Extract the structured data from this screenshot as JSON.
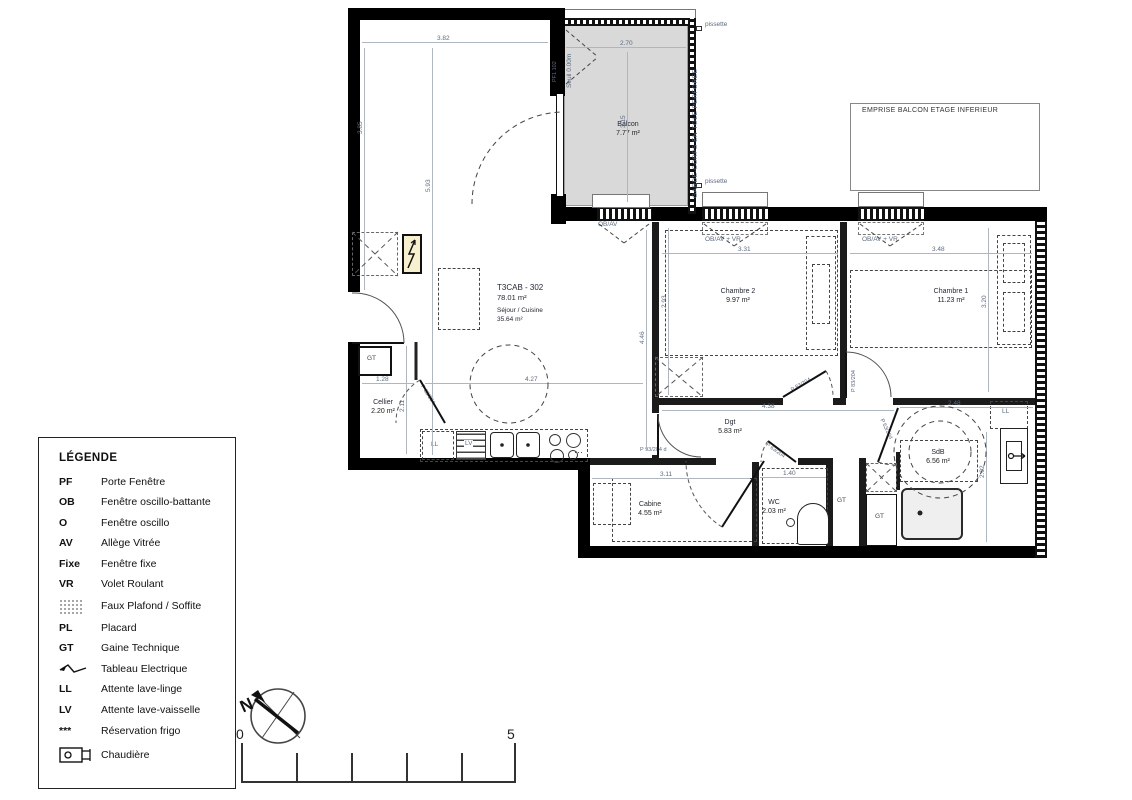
{
  "plan": {
    "unit_code": "T3CAB - 302",
    "unit_area": "78.01 m²",
    "rooms": {
      "sejour": {
        "name": "Séjour / Cuisine",
        "area": "35.64 m²"
      },
      "balcon": {
        "name": "Balcon",
        "area": "7.77 m²"
      },
      "chambre2": {
        "name": "Chambre 2",
        "area": "9.97 m²"
      },
      "chambre1": {
        "name": "Chambre 1",
        "area": "11.23 m²"
      },
      "cellier": {
        "name": "Cellier",
        "area": "2.20 m²"
      },
      "dgt": {
        "name": "Dgt",
        "area": "5.83 m²"
      },
      "cabine": {
        "name": "Cabine",
        "area": "4.55 m²"
      },
      "wc": {
        "name": "WC",
        "area": "2.03 m²"
      },
      "sdb": {
        "name": "SdB",
        "area": "6.56 m²"
      }
    },
    "annotations": {
      "emprise_balcon": "EMPRISE BALCON ETAGE INFERIEUR",
      "garde_corps": "GARDE-CORPS EN TOLE PERFOREE",
      "seuil": "Seuil 0.00m",
      "pissette": "pissette",
      "win_obav": "OB/AV",
      "win_obav_vr": "OB/AV + VR",
      "gt": "GT",
      "ll": "LL",
      "lv": "LV",
      "frigo_dots": "···"
    },
    "doors": {
      "pf": "PF1 102",
      "p83": "P 83/204",
      "p63": "P 63/204",
      "entry": "P 93/204 d"
    },
    "dims": {
      "sejour_w": "3.82",
      "sejour_wall": "3.85",
      "sejour_h": "5.93",
      "balcon_w": "2.70",
      "balcon_h": "3.15",
      "ch2_w": "3.31",
      "ch2_h": "2.93",
      "ch1_w": "3.48",
      "ch1_h": "3.20",
      "sejour_right_h": "4.46",
      "kitchen_w": "4.27",
      "cellier_w": "1.28",
      "cellier_h": "2.11",
      "dgt_w": "4.38",
      "cabine_w": "3.11",
      "wc_w": "1.40",
      "sdb_w": "2.48",
      "sdb_h": "2.02"
    }
  },
  "legend": {
    "title": "LÉGENDE",
    "items": [
      {
        "abbr": "PF",
        "label": "Porte Fenêtre"
      },
      {
        "abbr": "OB",
        "label": "Fenêtre oscillo-battante"
      },
      {
        "abbr": "O",
        "label": "Fenêtre oscillo"
      },
      {
        "abbr": "AV",
        "label": "Allège Vitrée"
      },
      {
        "abbr": "Fixe",
        "label": "Fenêtre fixe"
      },
      {
        "abbr": "VR",
        "label": "Volet Roulant"
      },
      {
        "abbr": "",
        "label": "Faux Plafond / Soffite"
      },
      {
        "abbr": "PL",
        "label": "Placard"
      },
      {
        "abbr": "GT",
        "label": "Gaine Technique"
      },
      {
        "abbr": "",
        "label": "Tableau Electrique"
      },
      {
        "abbr": "LL",
        "label": "Attente lave-linge"
      },
      {
        "abbr": "LV",
        "label": "Attente lave-vaisselle"
      },
      {
        "abbr": "***",
        "label": "Réservation frigo"
      },
      {
        "abbr": "",
        "label": "Chaudière"
      }
    ]
  },
  "compass": {
    "north_label": "N"
  },
  "scale_bar": {
    "start_label": "0",
    "end_label": "5"
  },
  "colors": {
    "wall": "#000000",
    "balcony_fill": "#d9d9d9",
    "electric_panel_fill": "#f7f0cf",
    "dimension_text": "#5c6b80"
  }
}
